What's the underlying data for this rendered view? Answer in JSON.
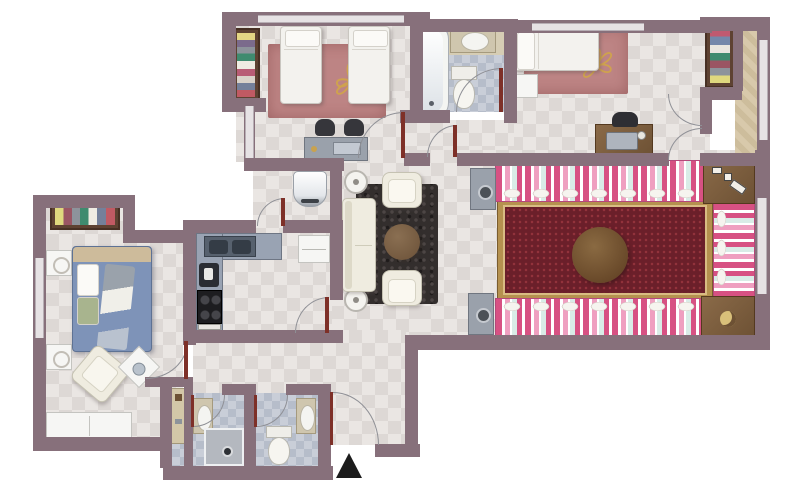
{
  "title": "Apartment floor plan (top-down rendered view)",
  "entrance": {
    "name": "Entrance",
    "marker": "north-facing black triangle at main door"
  },
  "palette": {
    "wall": "#87707b",
    "window": "#e6e2e4",
    "floor_tile_light": "#eae6e3",
    "floor_tile_dark": "#ddd8d5",
    "bath_tile": "#b6bdca",
    "balcony_beige": "#d8c9ab",
    "majlis_pink": "#d75183",
    "majlis_light_pink": "#ef9fc0",
    "majlis_mint": "#d9ece7",
    "carpet_red": "#6b1f2a",
    "carpet_gold": "#b5914f",
    "rug_rose": "#bd8484",
    "flower_gold": "#cfa24e",
    "wood": "#8a6a48",
    "sofa_cream": "#efece0",
    "shag_rug": "#332e2d",
    "bed_blue": "#7e93b8",
    "door_leaf": "#7e3028",
    "marker_black": "#1c1c1c"
  },
  "rooms": [
    {
      "name": "Kids' bedroom",
      "furniture": [
        "wardrobe with folded clothes",
        "twin bed",
        "twin bed",
        "rose rug with gold flower",
        "study desk",
        "two chairs"
      ]
    },
    {
      "name": "Family bathroom",
      "furniture": [
        "bathtub",
        "vanity sink",
        "toilet"
      ]
    },
    {
      "name": "Bedroom",
      "furniture": [
        "single bed",
        "rose rug with gold flower",
        "nightstand",
        "computer desk",
        "desk chair",
        "wardrobe with folded clothes"
      ]
    },
    {
      "name": "Living room (majlis)",
      "furniture": [
        "striped floor seating top",
        "striped floor seating right",
        "striped floor seating bottom",
        "red persian carpet",
        "round wooden table",
        "corner game table",
        "corner table with ashtray",
        "media unit",
        "media unit"
      ]
    },
    {
      "name": "Kitchen",
      "furniture": [
        "L-shaped counter",
        "double sink",
        "stove",
        "refrigerator"
      ]
    },
    {
      "name": "Master bedroom",
      "furniture": [
        "wardrobe with folded clothes",
        "double bed with blue bedding",
        "nightstand",
        "nightstand",
        "armchair",
        "side table",
        "dresser"
      ]
    },
    {
      "name": "Shower room",
      "furniture": [
        "sink",
        "shower tray"
      ]
    },
    {
      "name": "Toilet",
      "furniture": [
        "sink",
        "toilet"
      ]
    },
    {
      "name": "Entry hall",
      "furniture": [
        "entrance door",
        "direction marker"
      ]
    },
    {
      "name": "Hallway lounge",
      "furniture": [
        "sofa",
        "armchair",
        "armchair",
        "dark shag rug",
        "round coffee table",
        "side table",
        "side table",
        "water heater",
        "tall cabinet"
      ]
    },
    {
      "name": "Balcony",
      "furniture": []
    }
  ]
}
